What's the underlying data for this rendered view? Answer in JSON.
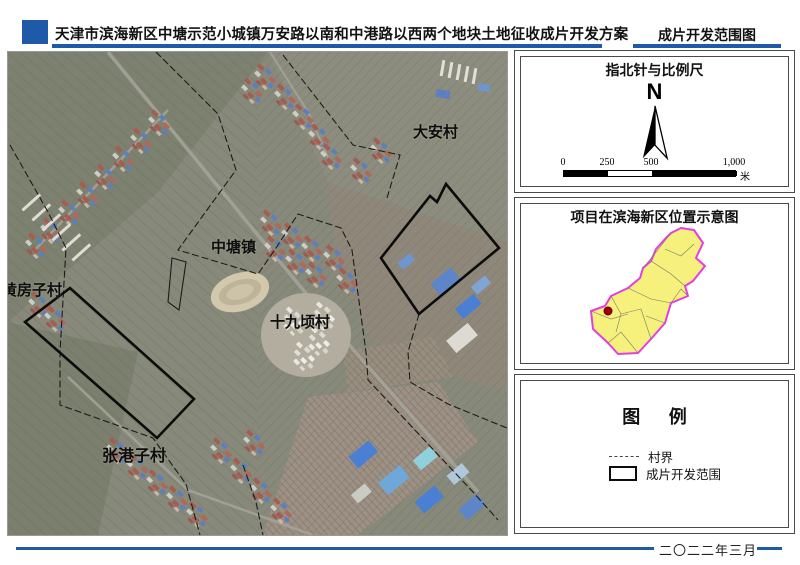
{
  "header": {
    "title": "天津市滨海新区中塘示范小城镇万安路以南和中港路以西两个地块土地征收成片开发方案",
    "sheet_title": "成片开发范围图"
  },
  "map": {
    "labels": [
      {
        "text": "大安村"
      },
      {
        "text": "中塘镇"
      },
      {
        "text": "黄房子村"
      },
      {
        "text": "十九顷村"
      },
      {
        "text": "张港子村"
      }
    ]
  },
  "panels": {
    "compass": {
      "title": "指北针与比例尺",
      "north": "N",
      "ticks": [
        "0",
        "250",
        "500",
        "1,000"
      ],
      "unit": "米"
    },
    "location": {
      "title": "项目在滨海新区位置示意图"
    },
    "legend": {
      "title": "图 例",
      "items": [
        {
          "symbol": "dashed-line",
          "label": "村界"
        },
        {
          "symbol": "rectangle-outline",
          "label": "成片开发范围"
        }
      ]
    }
  },
  "footer": {
    "date": "二〇二二年三月"
  },
  "colors": {
    "accent_blue": "#1e5aa8",
    "region_fill": "#f6f17c",
    "region_border": "#e23ee2",
    "marker_red": "#a00000",
    "development_outline": "#0c0c0c"
  }
}
